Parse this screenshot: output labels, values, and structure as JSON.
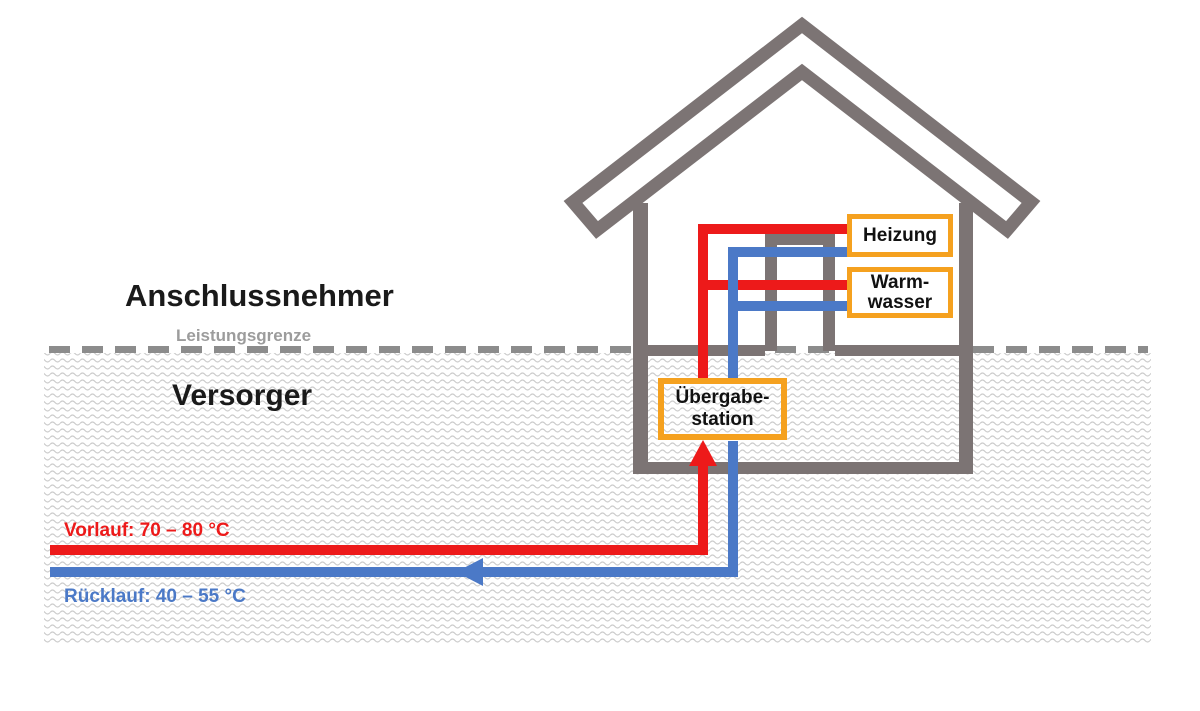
{
  "zones": {
    "customer_label": "Anschlussnehmer",
    "boundary_label": "Leistungsgrenze",
    "supplier_label": "Versorger"
  },
  "house": {
    "heating_label": "Heizung",
    "hot_water_line1": "Warm-",
    "hot_water_line2": "wasser"
  },
  "station": {
    "line1": "Übergabe-",
    "line2": "station"
  },
  "pipes": {
    "supply_label": "Vorlauf: 70 – 80 °C",
    "return_label": "Rücklauf: 40 – 55 °C",
    "supply_arrow_direction": "up",
    "return_arrow_direction": "left"
  },
  "colors": {
    "supply_red": "#ed1a1a",
    "return_blue": "#4b79c7",
    "box_orange": "#f5a11f",
    "house_gray": "#7c7474",
    "boundary_dash_gray": "#8c8c8c",
    "boundary_text_gray": "#9c9c9c",
    "ground_pattern_gray": "#cccccc"
  }
}
